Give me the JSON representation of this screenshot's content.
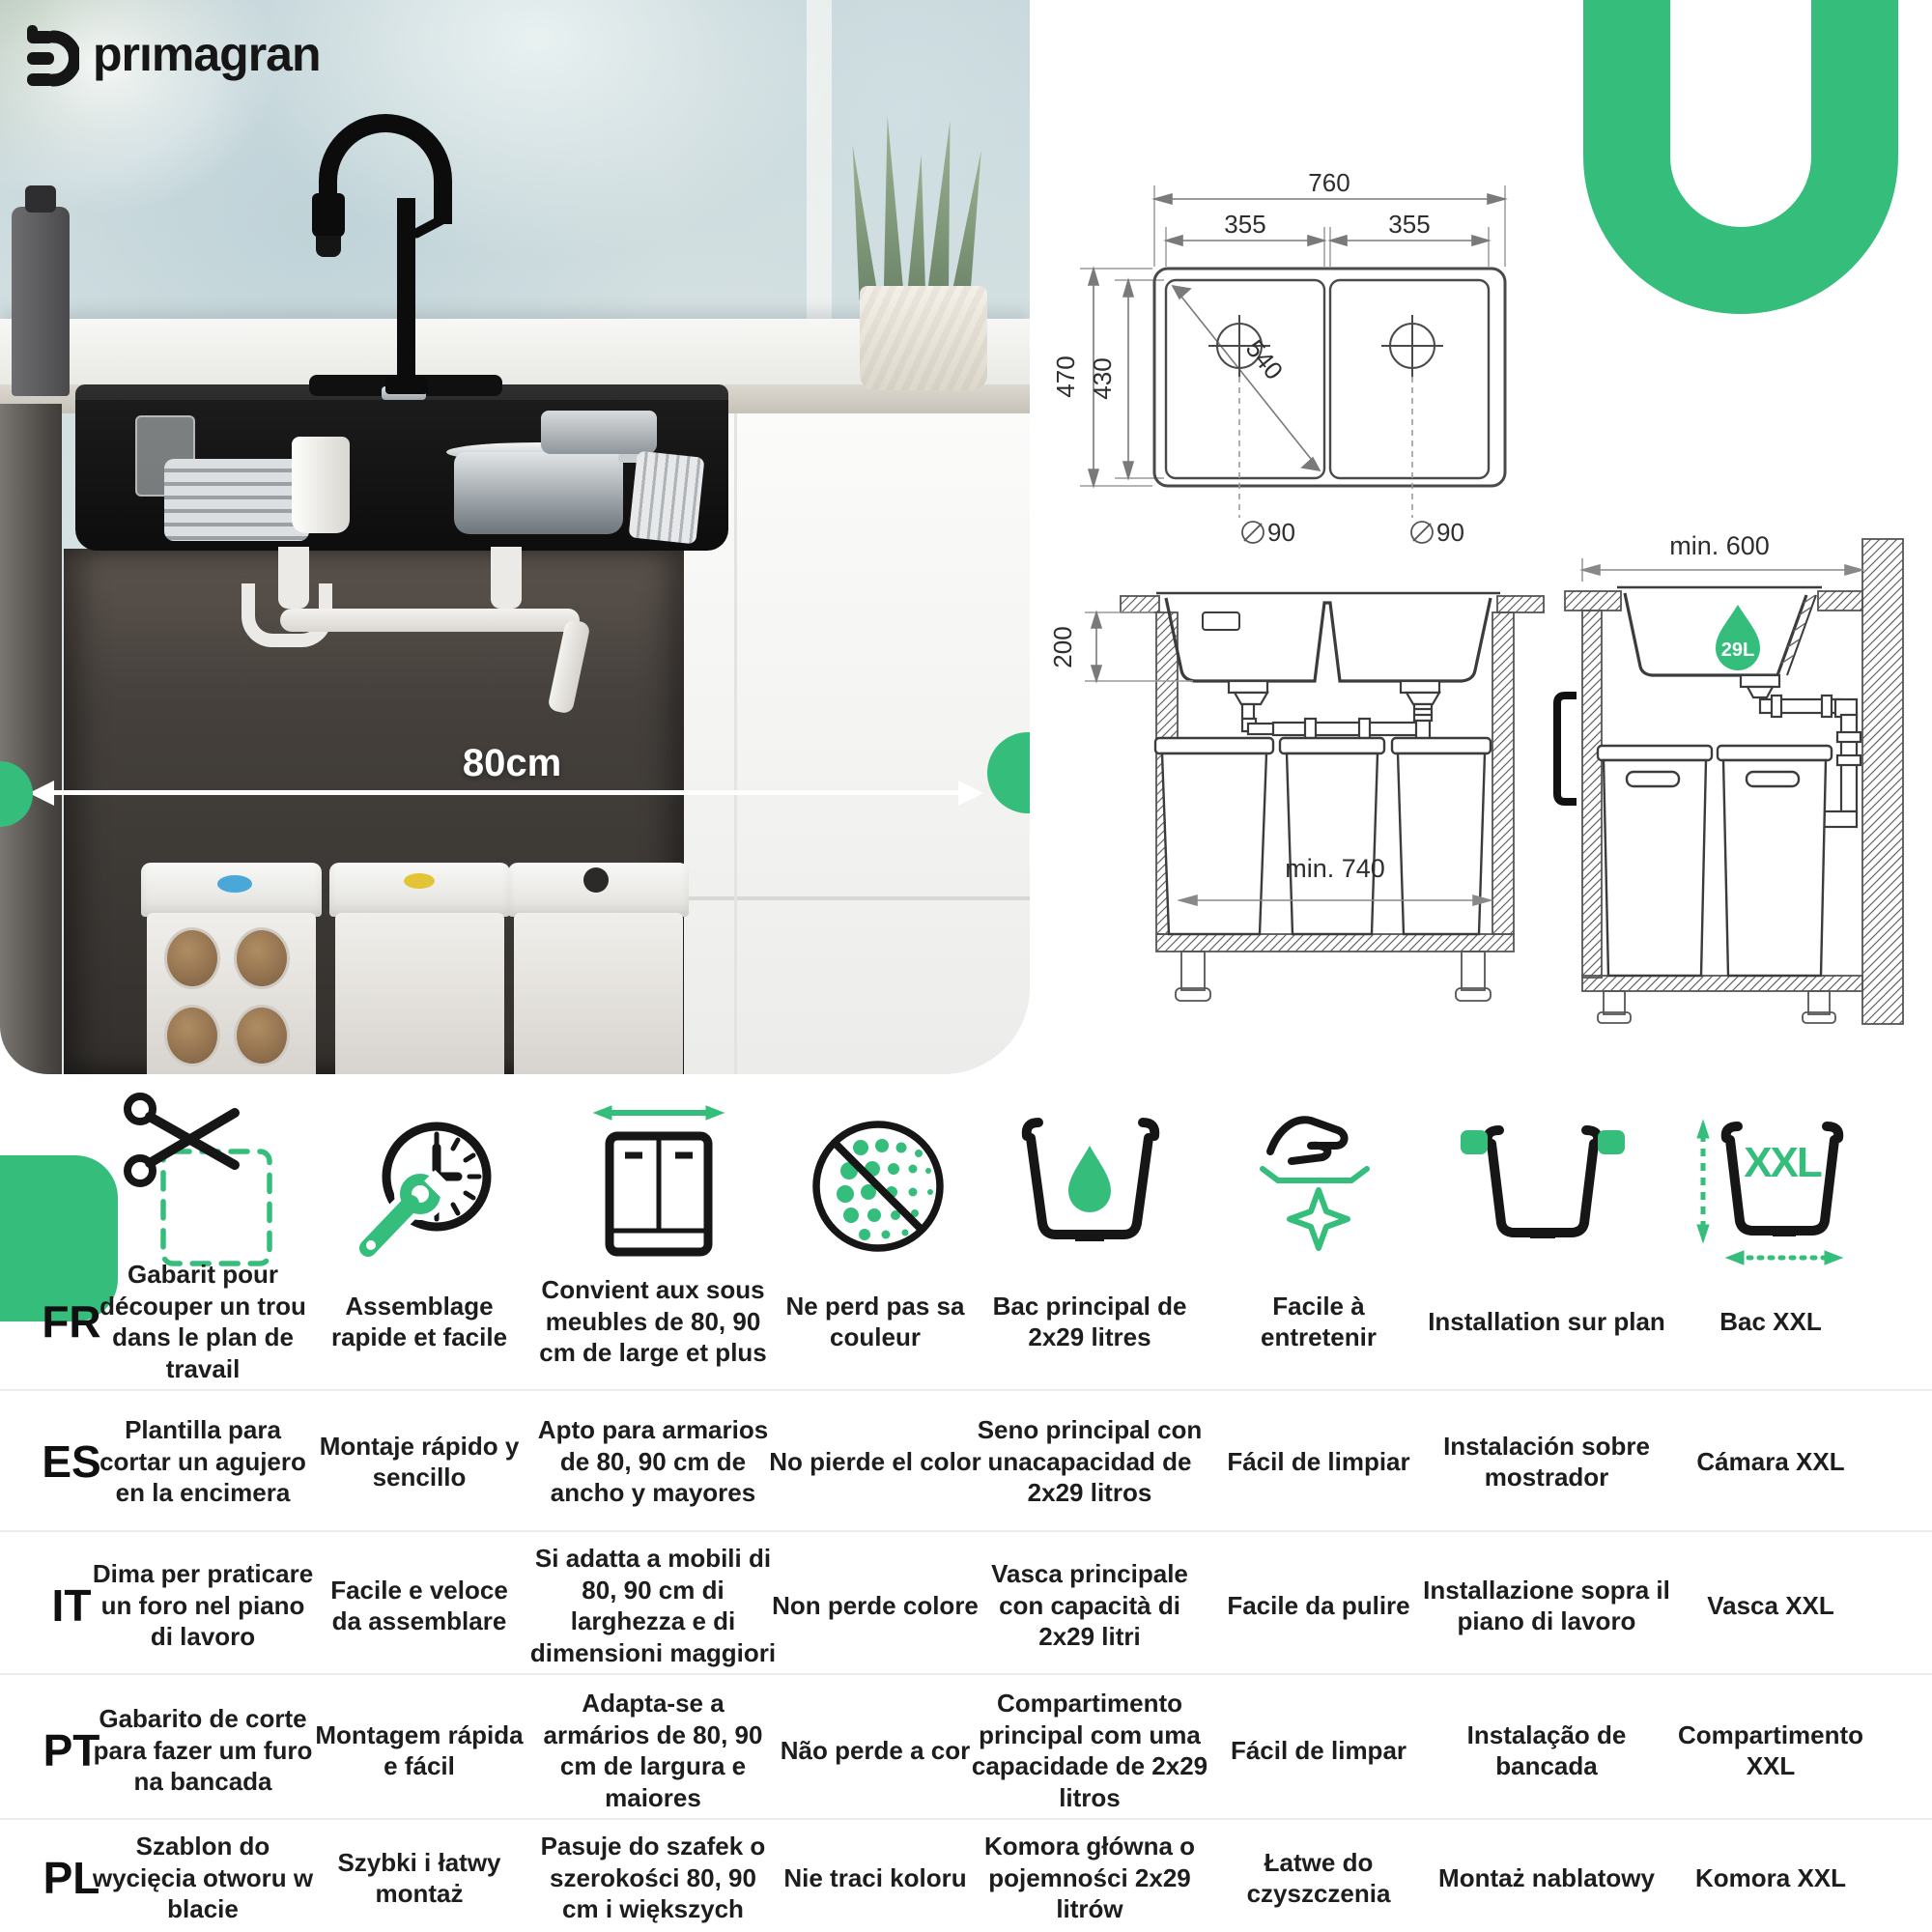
{
  "brand": {
    "logo_text": "prımagran",
    "accent_green": "#35bd7b"
  },
  "photo": {
    "cabinet_width_label": "80cm"
  },
  "diagrams": {
    "top_view": {
      "total_width": "760",
      "left_bowl_width": "355",
      "right_bowl_width": "355",
      "total_depth": "470",
      "bowl_depth": "430",
      "diagonal": "540",
      "left_drain_diameter": "90",
      "right_drain_diameter": "90"
    },
    "front_section": {
      "bowl_height": "200",
      "min_interior_width": "min. 740"
    },
    "side_section": {
      "min_cabinet_depth": "min. 600",
      "capacity_badge": "29L"
    }
  },
  "features": {
    "xxl_label": "XXL",
    "icons": [
      "cutout-template",
      "quick-assembly",
      "cabinet-width",
      "colorfast",
      "main-bowl-capacity",
      "easy-clean",
      "countertop-installation",
      "xxl-bowl"
    ],
    "rows": [
      {
        "code": "FR",
        "cells": [
          "Gabarit pour découper un trou dans le plan de travail",
          "Assemblage rapide et facile",
          "Convient aux sous meubles de 80, 90 cm de large et plus",
          "Ne perd pas sa couleur",
          "Bac principal de 2x29 litres",
          "Facile à entretenir",
          "Installation sur plan",
          "Bac XXL"
        ]
      },
      {
        "code": "ES",
        "cells": [
          "Plantilla para cortar un agujero en la encimera",
          "Montaje rápido y sencillo",
          "Apto para armarios de 80, 90 cm de ancho y mayores",
          "No pierde el color",
          "Seno principal con unacapacidad de 2x29 litros",
          "Fácil de limpiar",
          "Instalación sobre mostrador",
          "Cámara XXL"
        ]
      },
      {
        "code": "IT",
        "cells": [
          "Dima per praticare un foro nel piano di lavoro",
          "Facile e veloce da assemblare",
          "Si adatta a mobili di 80, 90 cm di larghezza e di dimensioni maggiori",
          "Non perde colore",
          "Vasca principale con capacità di 2x29 litri",
          "Facile da pulire",
          "Installazione sopra il piano di lavoro",
          "Vasca XXL"
        ]
      },
      {
        "code": "PT",
        "cells": [
          "Gabarito de corte para fazer um furo na bancada",
          "Montagem rápida e fácil",
          "Adapta-se a armários de 80, 90 cm de largura e maiores",
          "Não perde a cor",
          "Compartimento principal com uma capacidade de 2x29 litros",
          "Fácil de limpar",
          "Instalação de bancada",
          "Compartimento XXL"
        ]
      },
      {
        "code": "PL",
        "cells": [
          "Szablon do wycięcia otworu w blacie",
          "Szybki i łatwy montaż",
          "Pasuje do szafek o szerokości 80, 90 cm i większych",
          "Nie traci koloru",
          "Komora główna o pojemności 2x29 litrów",
          "Łatwe do czyszczenia",
          "Montaż nablatowy",
          "Komora XXL"
        ]
      }
    ]
  }
}
